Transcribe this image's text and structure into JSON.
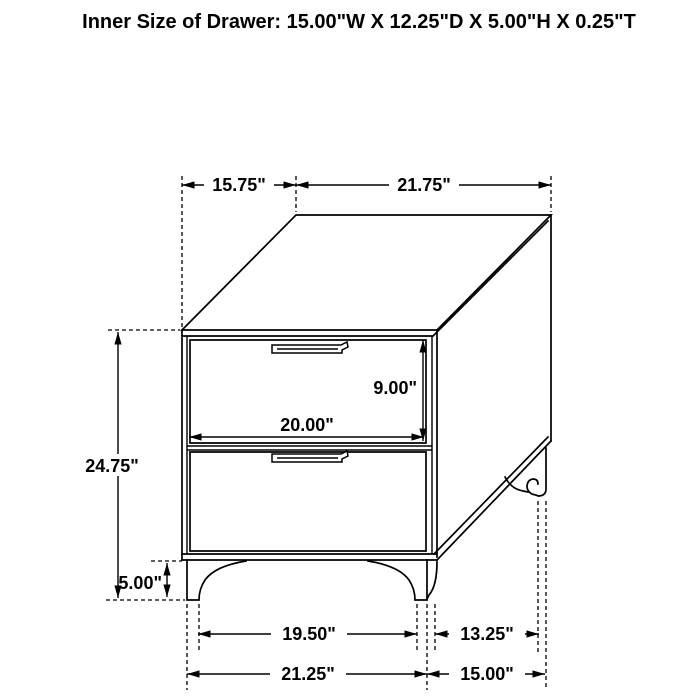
{
  "title": "Inner Size of Drawer: 15.00\"W X 12.25\"D X 5.00\"H X 0.25\"T",
  "diagram": {
    "subject": "two-drawer nightstand, 3D oblique dimension drawing",
    "drawer_count": 2,
    "dimensions": {
      "top_depth_offset": "15.75\"",
      "top_width": "21.75\"",
      "overall_height": "24.75\"",
      "drawer_opening_height": "9.00\"",
      "drawer_opening_width": "20.00\"",
      "leg_height": "5.00\"",
      "front_leg_inner_span": "19.50\"",
      "side_leg_span": "13.25\"",
      "front_base_width": "21.25\"",
      "side_base_depth": "15.00\""
    }
  }
}
